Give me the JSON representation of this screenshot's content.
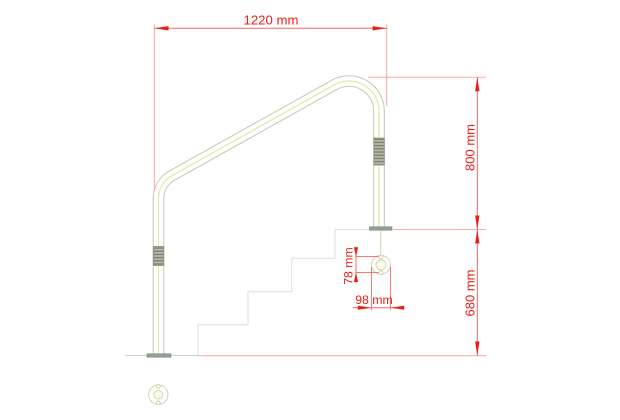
{
  "drawing": {
    "type": "technical-dimension-drawing",
    "subject": "Swimming pool stair handrail, side elevation with mounting flange detail",
    "units": "mm",
    "labels": {
      "width": "1220 mm",
      "height_upper": "800 mm",
      "height_lower": "680 mm",
      "flange_hole_spacing": "78 mm",
      "flange_diameter": "98 mm"
    },
    "colors": {
      "dimension_text": "#e8201a",
      "dimension_line": "#f0695f",
      "extension_line": "#f7aba4",
      "rail_outline": "#c7c7b5",
      "rail_fill": "#ffffff",
      "rail_highlight": "#e6e6a2",
      "grip_base": "#b7b7a6",
      "grip_stripe": "#767669",
      "stair_line": "#dbe4e6",
      "floor_line": "#c9d2c9",
      "plate": "#95a095",
      "flange_outline": "#d6d6bc",
      "background": "#ffffff"
    }
  }
}
